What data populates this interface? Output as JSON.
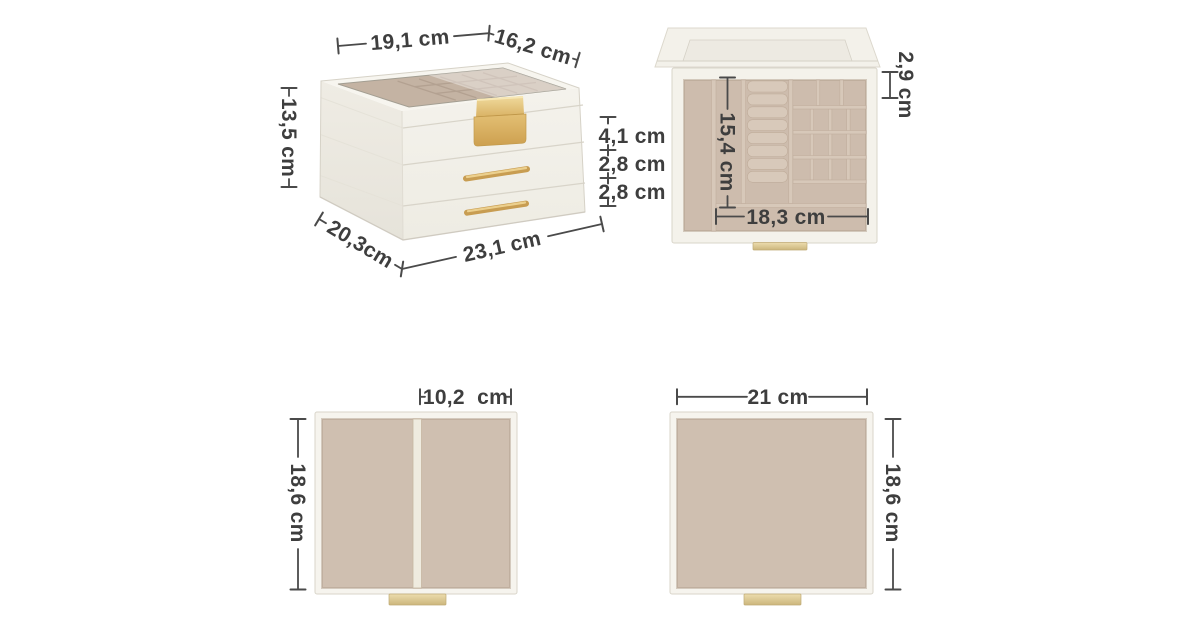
{
  "title": "Jewellery box dimension diagram",
  "unit": "cm",
  "colors": {
    "background": "#ffffff",
    "box_cream": "#f3f1ea",
    "velvet": "#cfbfb0",
    "velvet_dark": "#c4b3a3",
    "gold": "#d4aa5c",
    "pale_gold": "#dcc791",
    "dimension_line": "#4a4a4a",
    "text": "#3e3e3e"
  },
  "views": {
    "perspective": {
      "dims": {
        "top_width": "19,1 cm",
        "top_depth": "16,2 cm",
        "height": "13,5 cm",
        "tier_top": "4,1 cm",
        "tier_middle": "2,8 cm",
        "tier_bottom": "2,8 cm",
        "base_depth": "20,3cm",
        "base_width": "23,1 cm"
      }
    },
    "open_top": {
      "dims": {
        "inner_depth": "15,4 cm",
        "small_cell": "2,9 cm",
        "bottom_tray_width": "18,3 cm"
      }
    },
    "drawer_divided": {
      "dims": {
        "right_compartment_width": "10,2  cm",
        "depth": "18,6 cm"
      }
    },
    "drawer_plain": {
      "dims": {
        "width": "21 cm",
        "depth": "18,6 cm"
      }
    }
  }
}
